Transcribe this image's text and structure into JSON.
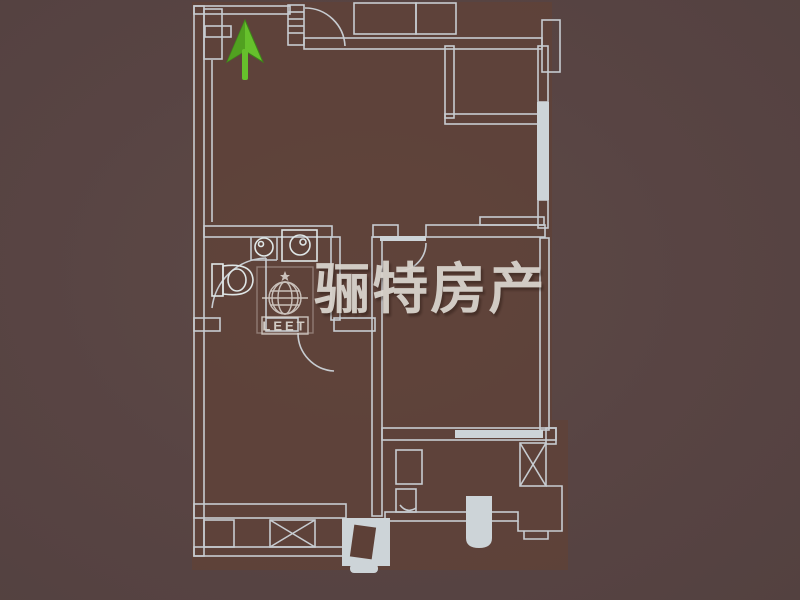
{
  "watermark": {
    "brand_text": "骊特房产",
    "logo_text": "LEET",
    "icons": [
      "globe-icon",
      "star-icon"
    ]
  },
  "north_arrow": {
    "direction": "up",
    "icon": "north-arrow-icon"
  },
  "colors": {
    "background": "#574442",
    "plan_floor": "#604237",
    "wall_line": "#c7ccd1",
    "wall_line_bright": "#dfe7e7",
    "wall_fill_solid": "#cdd4d8",
    "watermark_text": "#d8d3cc",
    "logo_line": "#ddd8d2",
    "arrow_green": "#66c02c",
    "arrow_green_dark": "#4d9b1f"
  }
}
